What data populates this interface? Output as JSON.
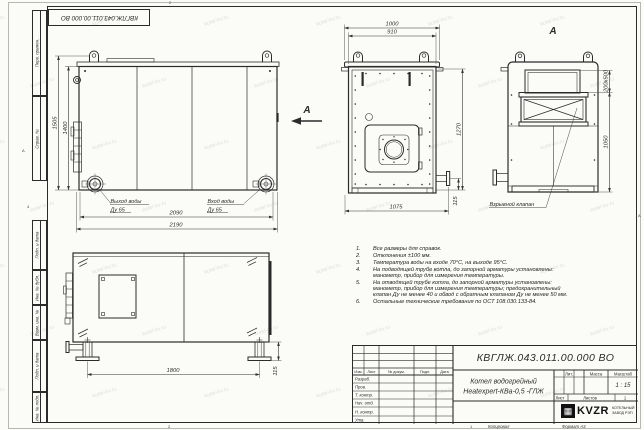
{
  "sheet": {
    "stamp_rotated": "КВГЛЖ.043.011.00.000 ВО",
    "watermark": "kotel-kv.ru",
    "zones": {
      "top": "2",
      "bottom_a": "2",
      "bottom_b": "1",
      "left_a": "А",
      "left_b": "4",
      "right_a": "А"
    },
    "margin_labels": {
      "perv": "Перв. примен.",
      "sprav": "Справ. №",
      "podp1": "Подп. и дата",
      "inv_dubl": "Инв. № дубл.",
      "vzam": "Взам. инв. №",
      "podp2": "Подп. и дата",
      "inv_podl": "Инв. № подл."
    },
    "footer": {
      "kopiroval": "Копировал",
      "format": "Формат А3"
    }
  },
  "views": {
    "side": {
      "dim_h_outer": "1505",
      "dim_h_inner": "1400",
      "dim_w_inner": "2090",
      "dim_w_outer": "2190",
      "out_label": "Выход воды",
      "out_dn": "Ду 65",
      "in_label": "Вход воды",
      "in_dn": "Ду 65",
      "view_arrow": "А"
    },
    "front": {
      "dim_top_outer": "1000",
      "dim_top_inner": "910",
      "dim_height": "1270",
      "dim_bottom": "1075",
      "dim_flange": "115"
    },
    "view_a": {
      "title": "А",
      "dim_valve": "200х500",
      "dim_height": "1050",
      "callout": "Взрывной клапан"
    },
    "rear": {
      "dim_legs": "1800",
      "dim_foot": "115"
    }
  },
  "notes": {
    "items": [
      {
        "num": "1.",
        "text": "Все размеры для справок."
      },
      {
        "num": "2.",
        "text": "Отклонения ±100 мм."
      },
      {
        "num": "3.",
        "text": "Температура воды на входе 70°С, на выходе 95°С."
      },
      {
        "num": "4.",
        "text": "На подводящей трубе котла, до запорной арматуры установлены: манометр, прибор для измерения температуры."
      },
      {
        "num": "5.",
        "text": "На отводящей трубе котла, до запорной арматуры установлены: манометр, прибор для измерения температуры; предохранительный клапан Ду не менее 40 и обвод с обратным клапаном Ду не менее 50 мм."
      },
      {
        "num": "6.",
        "text": "Остальные технические требования по ОСТ 108.030.133-84."
      }
    ]
  },
  "title_block": {
    "doc_number": "КВГЛЖ.043.011.00.000 ВО",
    "product_line1": "Котел водогрейный",
    "product_line2": "Heatexpert-КВа-0,5 -ГЛЖ",
    "col_izm": "Изм.",
    "col_list": "Лист",
    "col_doc": "№ докум.",
    "col_podp": "Подп.",
    "col_data": "Дата",
    "roles": [
      "Разраб.",
      "Пров.",
      "Т. контр.",
      "Нач. отд.",
      "Н. контр.",
      "Утв."
    ],
    "lit": "Лит.",
    "mass": "Масса",
    "scale": "Масштаб",
    "scale_value": "1 : 15",
    "sheet": "Лист",
    "sheets": "Листов",
    "sheets_value": "1",
    "logo_glyph": "▦",
    "logo_text": "KVZR",
    "logo_caption1": "КОТЕЛЬНЫЙ",
    "logo_caption2": "ЗАВОД РЭП"
  }
}
